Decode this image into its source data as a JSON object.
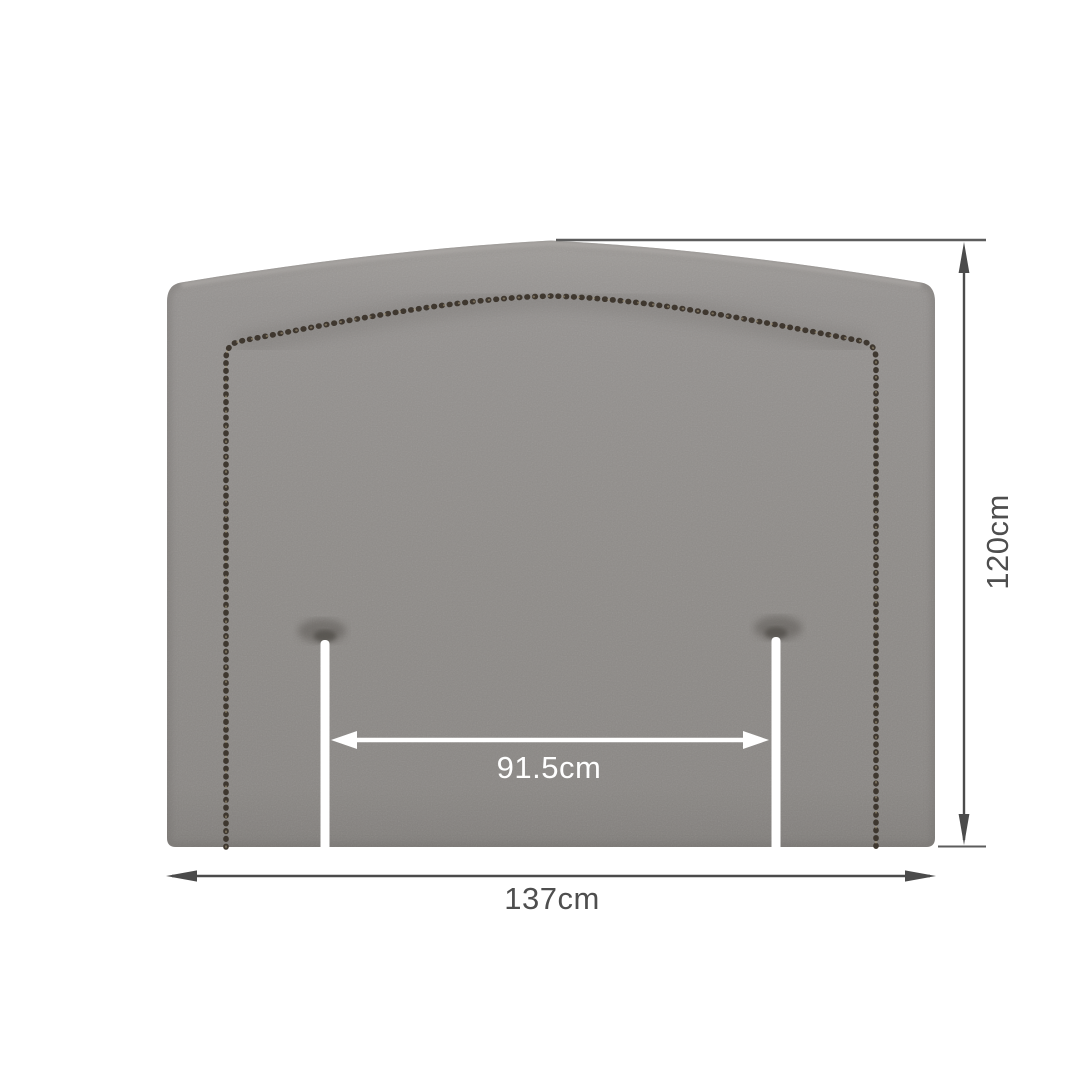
{
  "diagram": {
    "title": "Upholstered headboard dimension diagram",
    "product": "Fabric headboard with nailhead trim and two leg cut-out slots",
    "labels": {
      "height": "120cm",
      "width": "137cm",
      "inner_width": "91.5cm"
    },
    "colors": {
      "background": "#ffffff",
      "fabric": "#8f8c89",
      "nailhead_trim": "#3b342c",
      "dimension_dark": "#4b4b4b",
      "dimension_light": "#ffffff",
      "dark_text": "#4e4e4e",
      "light_text": "#ffffff"
    }
  }
}
